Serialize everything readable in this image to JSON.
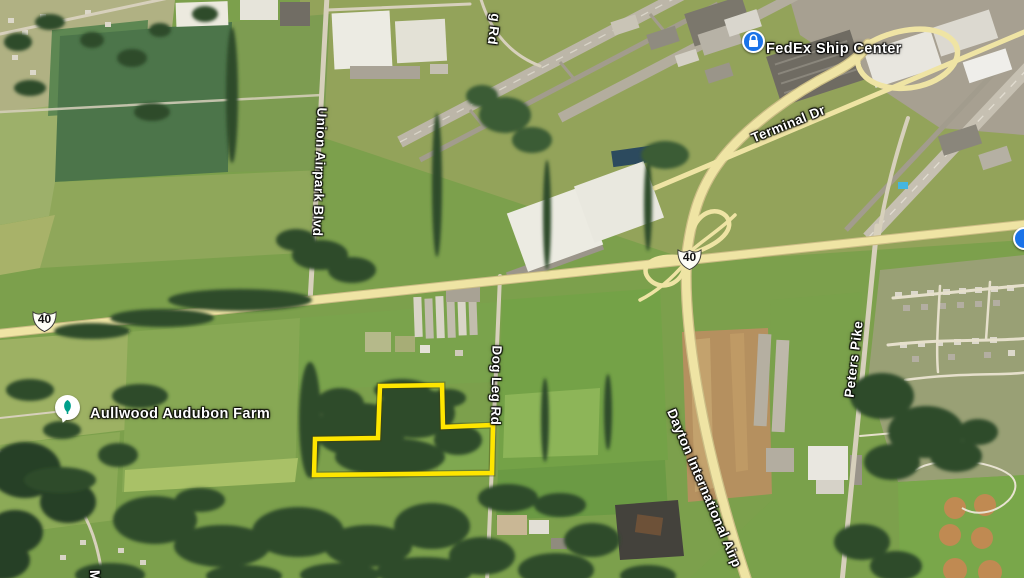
{
  "route_shields": {
    "us_40": "40"
  },
  "pois": {
    "fedex": {
      "label": "FedEx Ship Center",
      "icon": "package-icon",
      "icon_bg": "#1a73e8"
    },
    "aullwood": {
      "label": "Aullwood Audubon Farm",
      "icon": "nature-icon",
      "icon_bg": "#ffffff",
      "icon_glyph_color": "#00a08c"
    }
  },
  "roads": {
    "union_airpark_blvd": "Union Airpark Blvd",
    "terminal_dr": "Terminal Dr",
    "dog_leg_rd": "Dog Leg Rd",
    "dog_leg_rd_partial": "g Rd",
    "peters_pike": "Peters Pike",
    "dayton_international": "Dayton International Airp",
    "bottom_left_partial": "M"
  },
  "parcel": {
    "outline_color": "#ffe600"
  },
  "colors": {
    "field_green": "#7ca04c",
    "dark_field_green": "#4c754a",
    "tree_green": "#2d4b2a",
    "highway_yellow": "#efe4a4",
    "runway_gray": "#bcb6a8",
    "dirt_tan": "#b5905f",
    "poi_blue": "#1a73e8",
    "label_white": "#ffffff"
  }
}
